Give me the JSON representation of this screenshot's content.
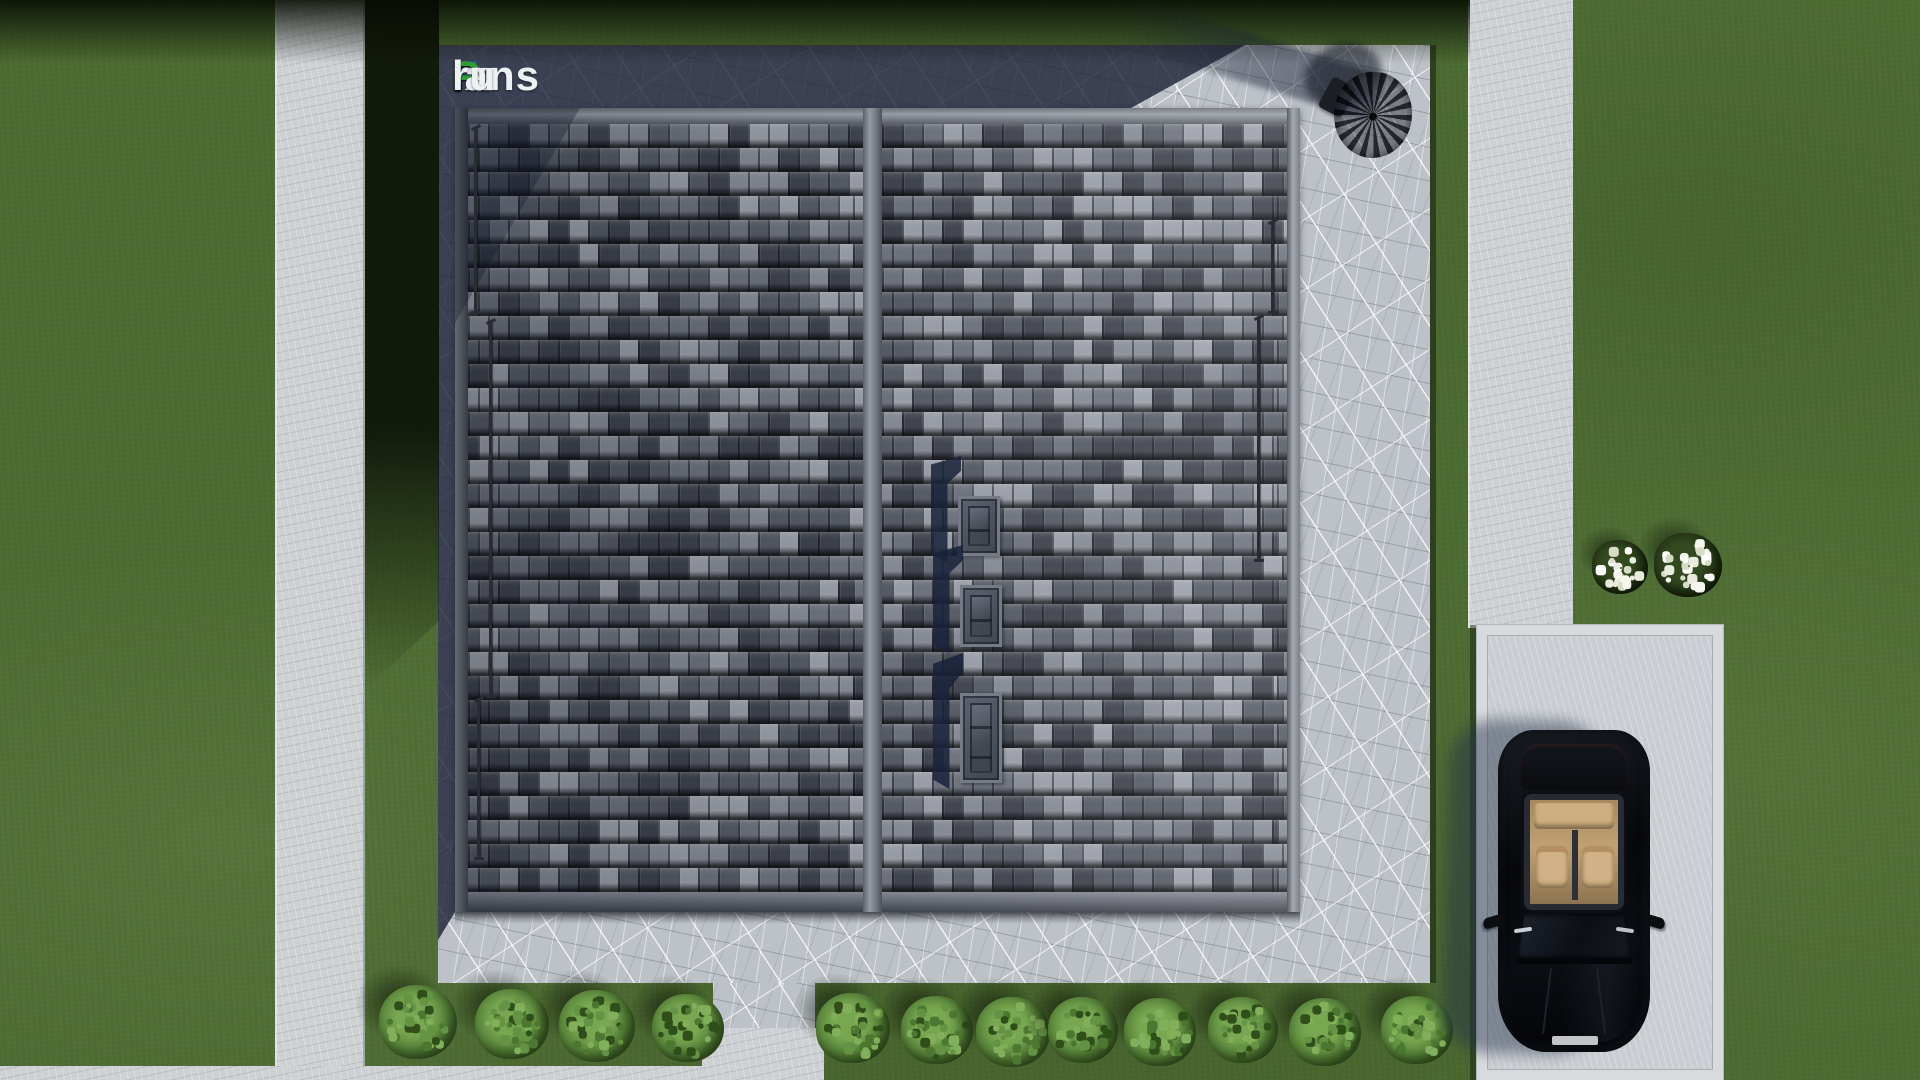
{
  "logo": {
    "text": "FixPlans.ru",
    "letters": [
      {
        "t": "F",
        "color": "#1d63d8"
      },
      {
        "t": "ix",
        "color": "#eef1f4"
      },
      {
        "t": "P",
        "color": "#2e9e33"
      },
      {
        "t": "lans",
        "color": "#eef1f4"
      },
      {
        "t": ".",
        "color": "#1d63d8"
      },
      {
        "t": "ru",
        "color": "#eef1f4"
      }
    ]
  },
  "scene": {
    "description_labels": [
      "lawn",
      "concrete-walkways",
      "stamped-concrete-patio",
      "tiled-roof-top-view",
      "roof-windows",
      "patio-umbrella",
      "driveway",
      "black-car",
      "garden-bushes",
      "white-flower-shrubs",
      "house-shadow"
    ],
    "palette": {
      "grass": "#4d6c32",
      "path_concrete": "#cdd1d4",
      "patio_concrete": "#bdc2c8",
      "shadow_tint": "#1a2036",
      "car_body": "#07080b",
      "car_interior": "#c0a171",
      "umbrella": "#0b0d12"
    },
    "roof": {
      "tile_palette": [
        "#3f434d",
        "#565b65",
        "#6e737e",
        "#878c96",
        "#9ca0a9"
      ],
      "tile_weights": [
        0.2,
        0.28,
        0.22,
        0.17,
        0.13
      ],
      "tile_width": 20,
      "row_height": 24,
      "rows": 32,
      "seed": 20240613,
      "skylights": [
        {
          "x": 503,
          "y": 388,
          "w": 42,
          "h": 60,
          "bars": 1
        },
        {
          "x": 505,
          "y": 477,
          "w": 42,
          "h": 62,
          "bars": 1
        },
        {
          "x": 505,
          "y": 585,
          "w": 42,
          "h": 90,
          "bars": 2
        }
      ],
      "rods": [
        {
          "x": 19,
          "y": 20,
          "h": 184
        },
        {
          "x": 34,
          "y": 214,
          "h": 374
        },
        {
          "x": 22,
          "y": 592,
          "h": 158
        },
        {
          "x": 816,
          "y": 114,
          "h": 90
        },
        {
          "x": 802,
          "y": 210,
          "h": 242
        }
      ]
    },
    "vegetation": {
      "bush_count_left": 4,
      "bush_count_right": 8,
      "bushes": [
        {
          "cx": 418,
          "cy": 1022,
          "r": 39
        },
        {
          "cx": 512,
          "cy": 1024,
          "r": 37
        },
        {
          "cx": 597,
          "cy": 1026,
          "r": 38
        },
        {
          "cx": 688,
          "cy": 1028,
          "r": 36
        },
        {
          "cx": 853,
          "cy": 1028,
          "r": 37
        },
        {
          "cx": 937,
          "cy": 1030,
          "r": 36
        },
        {
          "cx": 1013,
          "cy": 1032,
          "r": 37
        },
        {
          "cx": 1083,
          "cy": 1030,
          "r": 35
        },
        {
          "cx": 1160,
          "cy": 1032,
          "r": 36
        },
        {
          "cx": 1243,
          "cy": 1030,
          "r": 35
        },
        {
          "cx": 1325,
          "cy": 1032,
          "r": 36
        },
        {
          "cx": 1417,
          "cy": 1030,
          "r": 36
        }
      ],
      "flower_shrubs": [
        {
          "cx": 1620,
          "cy": 567,
          "r": 28,
          "dots": 20
        },
        {
          "cx": 1688,
          "cy": 565,
          "r": 34,
          "dots": 28
        }
      ]
    }
  }
}
